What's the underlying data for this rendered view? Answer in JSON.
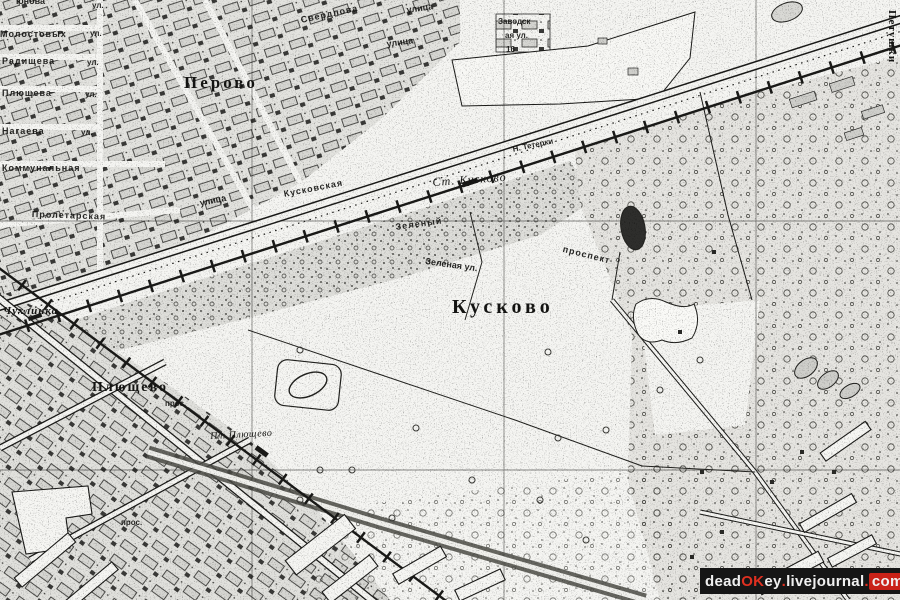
{
  "map": {
    "type": "scanned-topographic-city-map",
    "ink_color": "#1a1a18",
    "paper_color": "#f5f5f2",
    "labels": [
      {
        "text": "Перово",
        "x": 184,
        "y": 74,
        "fs": 17,
        "ls": 3,
        "cls": "region"
      },
      {
        "text": "Кусково",
        "x": 452,
        "y": 297,
        "fs": 20,
        "ls": 4,
        "cls": "region"
      },
      {
        "text": "Плющево",
        "x": 92,
        "y": 381,
        "fs": 14,
        "ls": 2,
        "cls": "region"
      },
      {
        "text": "Чухлинка",
        "x": 3,
        "y": 306,
        "fs": 11,
        "ls": 1,
        "cls": "region",
        "it": true
      },
      {
        "text": "Петушки",
        "x": 897,
        "y": 10,
        "fs": 11,
        "ls": 1,
        "cls": "region",
        "rot": 90
      },
      {
        "text": "Ст. Кусково",
        "x": 432,
        "y": 176,
        "fs": 12,
        "ls": 1,
        "cls": "station",
        "rot": -4,
        "it": true
      },
      {
        "text": "Пл. Плющево",
        "x": 210,
        "y": 432,
        "fs": 10,
        "ls": 0.5,
        "cls": "station",
        "rot": -3,
        "it": true
      },
      {
        "text": "юнова",
        "x": 16,
        "y": -3,
        "fs": 9,
        "cls": "street"
      },
      {
        "text": "Молостовых",
        "x": 0,
        "y": 30,
        "fs": 9,
        "ls": 1,
        "cls": "street"
      },
      {
        "text": "Радищева",
        "x": 2,
        "y": 57,
        "fs": 9,
        "ls": 1,
        "cls": "street"
      },
      {
        "text": "Плющева",
        "x": 2,
        "y": 89,
        "fs": 9,
        "ls": 1,
        "cls": "street"
      },
      {
        "text": "Нагаева",
        "x": 2,
        "y": 127,
        "fs": 9,
        "ls": 1,
        "cls": "street"
      },
      {
        "text": "Коммунальная",
        "x": 2,
        "y": 164,
        "fs": 9,
        "ls": 1,
        "cls": "street"
      },
      {
        "text": "Пролетарская",
        "x": 32,
        "y": 210,
        "fs": 9,
        "ls": 1,
        "cls": "street",
        "rot": 2
      },
      {
        "text": "ул.",
        "x": 92,
        "y": 2,
        "fs": 8,
        "cls": "street"
      },
      {
        "text": "ул.",
        "x": 90,
        "y": 30,
        "fs": 8,
        "cls": "street"
      },
      {
        "text": "ул.",
        "x": 87,
        "y": 59,
        "fs": 8,
        "cls": "street"
      },
      {
        "text": "ул.",
        "x": 85,
        "y": 91,
        "fs": 8,
        "cls": "street"
      },
      {
        "text": "ул.",
        "x": 81,
        "y": 129,
        "fs": 8,
        "cls": "street"
      },
      {
        "text": "Свердлова",
        "x": 300,
        "y": 16,
        "fs": 9,
        "ls": 1,
        "cls": "street",
        "rot": -12
      },
      {
        "text": "улица",
        "x": 406,
        "y": 6,
        "fs": 9,
        "cls": "street",
        "rot": -8
      },
      {
        "text": "улица",
        "x": 386,
        "y": 40,
        "fs": 9,
        "cls": "street",
        "rot": -8
      },
      {
        "text": "Заводск",
        "x": 498,
        "y": 18,
        "fs": 8,
        "cls": "street"
      },
      {
        "text": "ая ул.",
        "x": 505,
        "y": 32,
        "fs": 8,
        "cls": "street"
      },
      {
        "text": "16",
        "x": 506,
        "y": 46,
        "fs": 8,
        "cls": "street"
      },
      {
        "text": "Кусковская",
        "x": 283,
        "y": 190,
        "fs": 9,
        "ls": 1,
        "cls": "street",
        "rot": -11
      },
      {
        "text": "улица",
        "x": 199,
        "y": 199,
        "fs": 9,
        "cls": "street",
        "rot": -11
      },
      {
        "text": "Н. Тетерки",
        "x": 512,
        "y": 146,
        "fs": 8,
        "cls": "street",
        "rot": -12
      },
      {
        "text": "Зелёный",
        "x": 395,
        "y": 223,
        "fs": 9,
        "ls": 1,
        "cls": "street",
        "rot": -8
      },
      {
        "text": "проспект",
        "x": 564,
        "y": 245,
        "fs": 9,
        "ls": 1,
        "cls": "street",
        "rot": 14
      },
      {
        "text": "Зеленая ул.",
        "x": 426,
        "y": 257,
        "fs": 9,
        "cls": "street",
        "rot": 8
      },
      {
        "text": "прос.",
        "x": 165,
        "y": 400,
        "fs": 8,
        "cls": "street"
      },
      {
        "text": "прос.",
        "x": 121,
        "y": 519,
        "fs": 8,
        "cls": "street"
      }
    ]
  },
  "watermark": {
    "full_text": "deadOKey.livejournal.com",
    "parts": [
      {
        "t": "dead",
        "c": "#f0f0f0"
      },
      {
        "t": "OK",
        "c": "#e03020"
      },
      {
        "t": "ey",
        "c": "#f0f0f0"
      },
      {
        "t": ".",
        "c": "#e03020"
      },
      {
        "t": "livejournal",
        "c": "#f0f0f0"
      },
      {
        "t": ".",
        "c": "#e03020"
      },
      {
        "t": "com",
        "c": "#f0f0f0",
        "bg": "#c92218"
      }
    ]
  }
}
